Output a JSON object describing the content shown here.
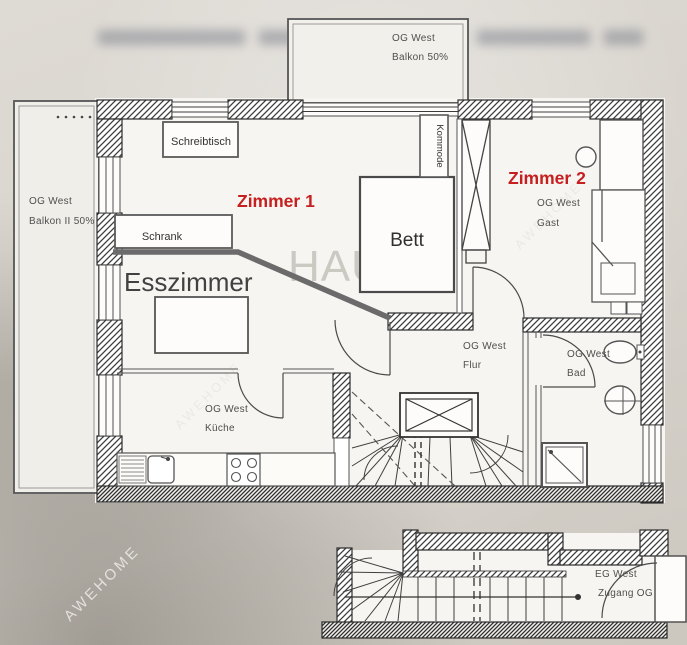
{
  "colors": {
    "accent_red": "#c51f1f",
    "ink": "#2e2e2e",
    "annotation_gray": "#6b6b6b",
    "paper": "#f7f5f1",
    "scan_background": "#d7d3cc"
  },
  "plan": {
    "balcony_top": {
      "l1": "OG West",
      "l2": "Balkon 50%"
    },
    "balcony_left": {
      "l1": "OG West",
      "l2": "Balkon II 50%"
    },
    "zimmer1": {
      "label": "Zimmer 1"
    },
    "zimmer2": {
      "label": "Zimmer 2",
      "l1": "OG West",
      "l2": "Gast"
    },
    "esszimmer": {
      "label": "Esszimmer"
    },
    "kueche": {
      "l1": "OG West",
      "l2": "Küche"
    },
    "flur": {
      "l1": "OG West",
      "l2": "Flur"
    },
    "bad": {
      "l1": "OG West",
      "l2": "Bad"
    },
    "eg_zugang": {
      "l1": "EG West",
      "l2": "Zugang OG"
    }
  },
  "furniture": {
    "schreibtisch": "Schreibtisch",
    "schrank": "Schrank",
    "bett": "Bett",
    "kommode": "Kommode"
  },
  "watermarks": {
    "hau": "HAU",
    "brand": "AWEHOME"
  }
}
